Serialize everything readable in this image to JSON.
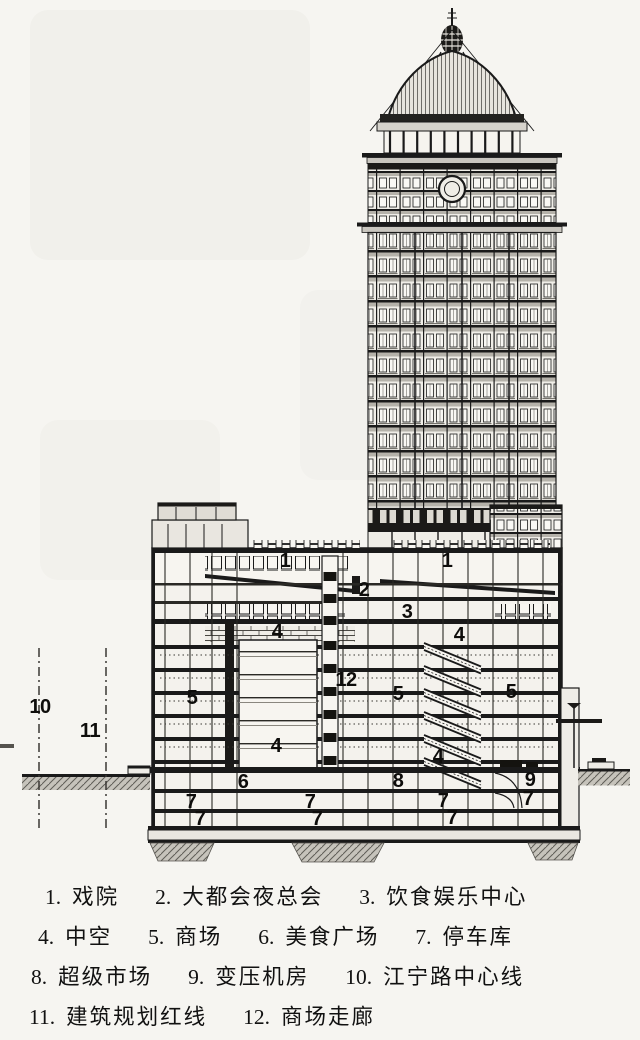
{
  "document": {
    "type": "architectural-section-drawing",
    "language": "zh",
    "ink_color": "#1a1a1a",
    "paper_color": "#f6f5f1"
  },
  "drawing": {
    "callouts": [
      {
        "label": "1"
      },
      {
        "label": "1"
      },
      {
        "label": "2"
      },
      {
        "label": "3"
      },
      {
        "label": "4"
      },
      {
        "label": "4"
      },
      {
        "label": "5"
      },
      {
        "label": "12"
      },
      {
        "label": "5"
      },
      {
        "label": "5"
      },
      {
        "label": "4"
      },
      {
        "label": "4"
      },
      {
        "label": "6"
      },
      {
        "label": "8"
      },
      {
        "label": "9"
      },
      {
        "label": "7"
      },
      {
        "label": "7"
      },
      {
        "label": "7"
      },
      {
        "label": "7"
      },
      {
        "label": "7"
      },
      {
        "label": "7"
      },
      {
        "label": "7"
      },
      {
        "label": "10"
      },
      {
        "label": "11"
      }
    ]
  },
  "legend": {
    "rows": [
      {
        "items": [
          {
            "num": "1.",
            "label": "戏院"
          },
          {
            "num": "2.",
            "label": "大都会夜总会"
          },
          {
            "num": "3.",
            "label": "饮食娱乐中心"
          }
        ]
      },
      {
        "items": [
          {
            "num": "4.",
            "label": "中空"
          },
          {
            "num": "5.",
            "label": "商场"
          },
          {
            "num": "6.",
            "label": "美食广场"
          },
          {
            "num": "7.",
            "label": "停车库"
          }
        ]
      },
      {
        "items": [
          {
            "num": "8.",
            "label": "超级市场"
          },
          {
            "num": "9.",
            "label": "变压机房"
          },
          {
            "num": "10.",
            "label": "江宁路中心线"
          }
        ]
      },
      {
        "items": [
          {
            "num": "11.",
            "label": "建筑规划红线"
          },
          {
            "num": "12.",
            "label": "商场走廊"
          }
        ]
      }
    ]
  }
}
